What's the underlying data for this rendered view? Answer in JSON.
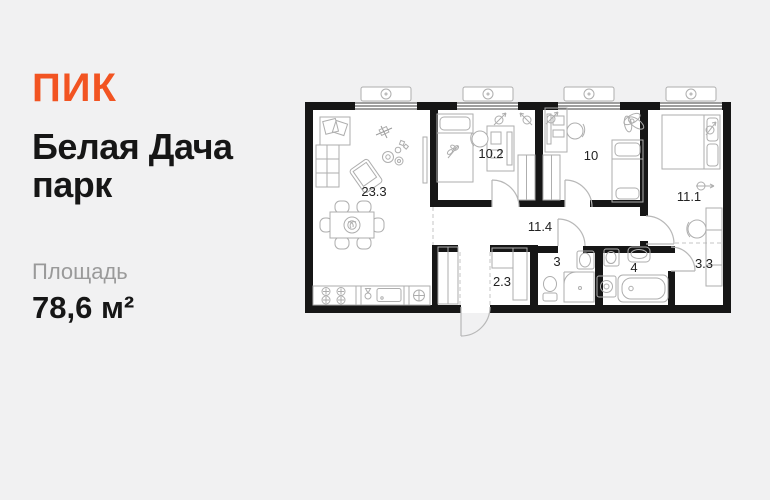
{
  "page": {
    "background": "#f1f1f2"
  },
  "brand": {
    "logo_text": "ПИК",
    "color": "#F25422"
  },
  "listing": {
    "project_title": "Белая Дача парк",
    "area_label": "Площадь",
    "area_value": "78,6 м²"
  },
  "floorplan": {
    "wall_color": "#161616",
    "rooms": [
      {
        "name": "living-kitchen",
        "label": "23.3"
      },
      {
        "name": "bedroom-1",
        "label": "10.2"
      },
      {
        "name": "bedroom-2",
        "label": "10"
      },
      {
        "name": "bedroom-3",
        "label": "11.1"
      },
      {
        "name": "hallway",
        "label": "11.4"
      },
      {
        "name": "storage",
        "label": "2.3"
      },
      {
        "name": "bathroom-1",
        "label": "3"
      },
      {
        "name": "bathroom-2",
        "label": "4"
      },
      {
        "name": "wardrobe",
        "label": "3.3"
      }
    ]
  }
}
